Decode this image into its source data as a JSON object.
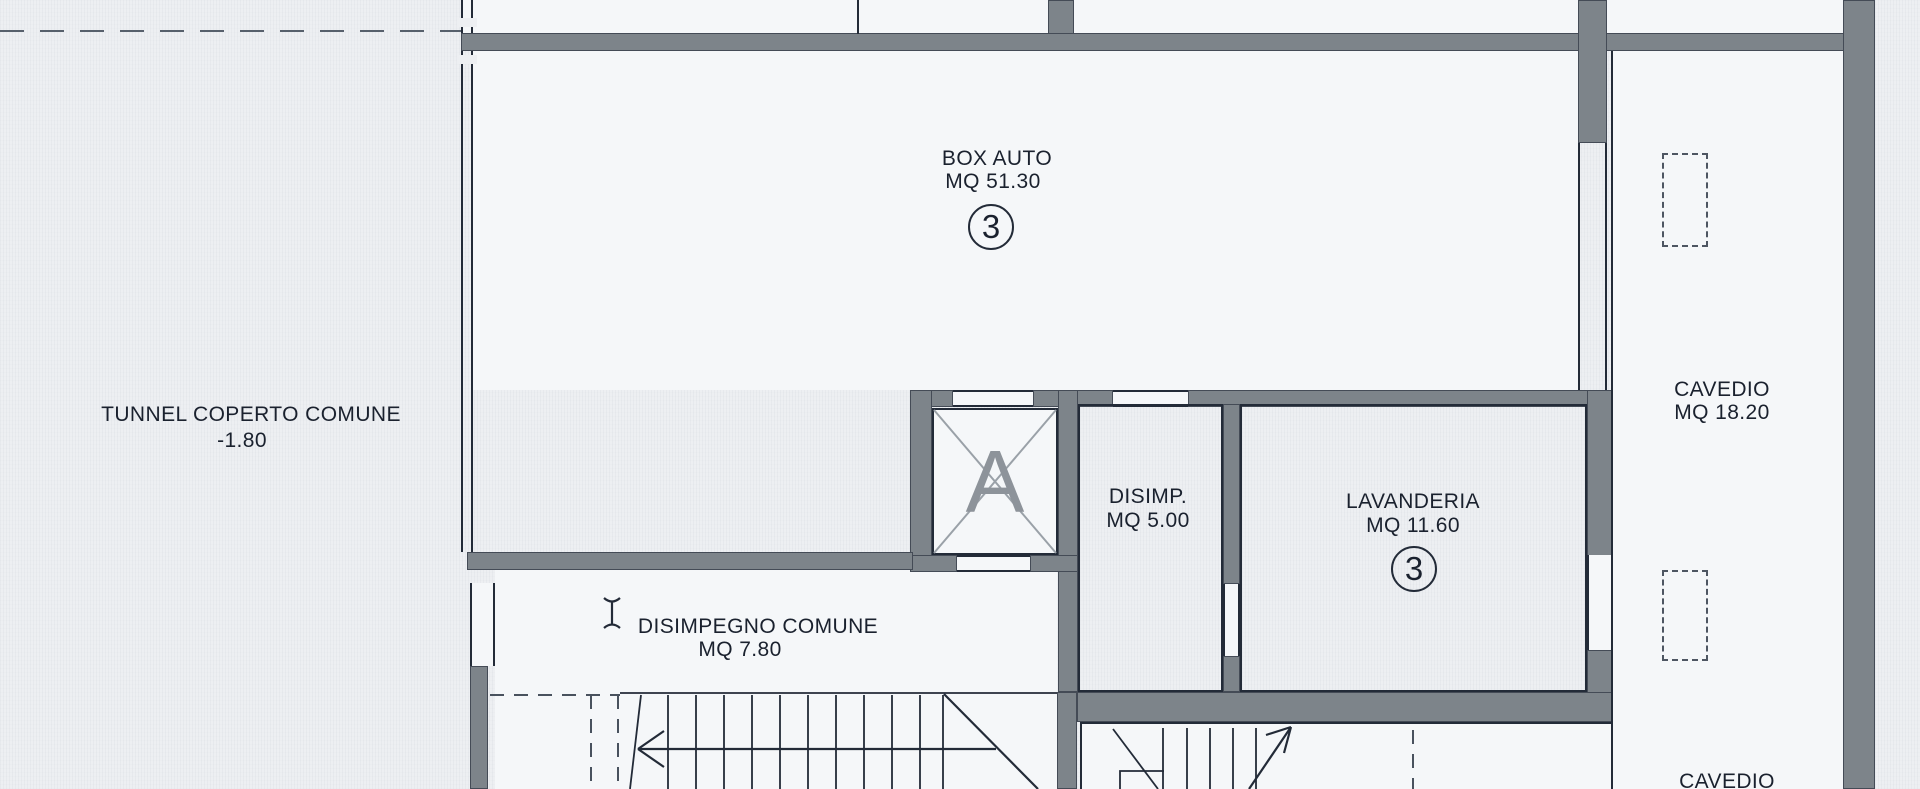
{
  "colors": {
    "paper": "#edeff2",
    "room": "#f5f7f9",
    "wall": "#7d848a",
    "line": "#232b38",
    "muted": "#8d939a",
    "text": "#1a212e"
  },
  "icons": {
    "cursor": "text-cursor-icon"
  },
  "rooms": {
    "tunnel": {
      "name": "TUNNEL COPERTO COMUNE",
      "level": "-1.80"
    },
    "box_auto": {
      "name": "BOX AUTO",
      "area": "MQ 51.30",
      "unit": "3"
    },
    "elevator": {
      "label": "A"
    },
    "disimp": {
      "name": "DISIMP.",
      "area": "MQ 5.00"
    },
    "lavanderia": {
      "name": "LAVANDERIA",
      "area": "MQ 11.60",
      "unit": "3"
    },
    "cavedio_upper": {
      "name": "CAVEDIO",
      "area": "MQ 18.20"
    },
    "disimpegno_comune": {
      "name": "DISIMPEGNO COMUNE",
      "area": "MQ 7.80"
    },
    "cavedio_lower": {
      "name": "CAVEDIO"
    }
  }
}
